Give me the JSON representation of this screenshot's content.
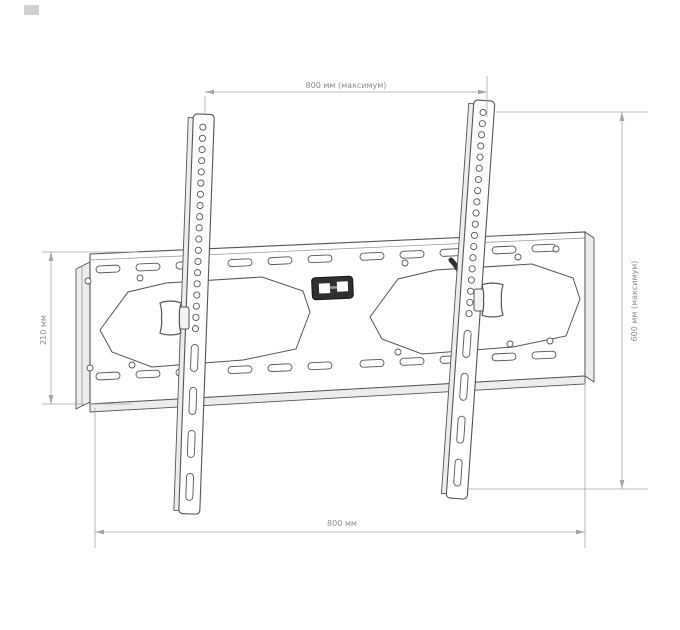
{
  "colors": {
    "outline": "#555555",
    "light_line": "#8f8f8f",
    "side_shade": "#ececec",
    "dim_line": "#a6a6a6",
    "dim_text": "#8c8c8c",
    "dark_fill": "#2f2f2f",
    "background": "#ffffff"
  },
  "dimensions": {
    "top": {
      "label": "800 мм (максимум)"
    },
    "right": {
      "label": "600 мм (максимум)"
    },
    "left": {
      "label": "210 мм"
    },
    "bottom": {
      "label": "800 мм"
    }
  }
}
